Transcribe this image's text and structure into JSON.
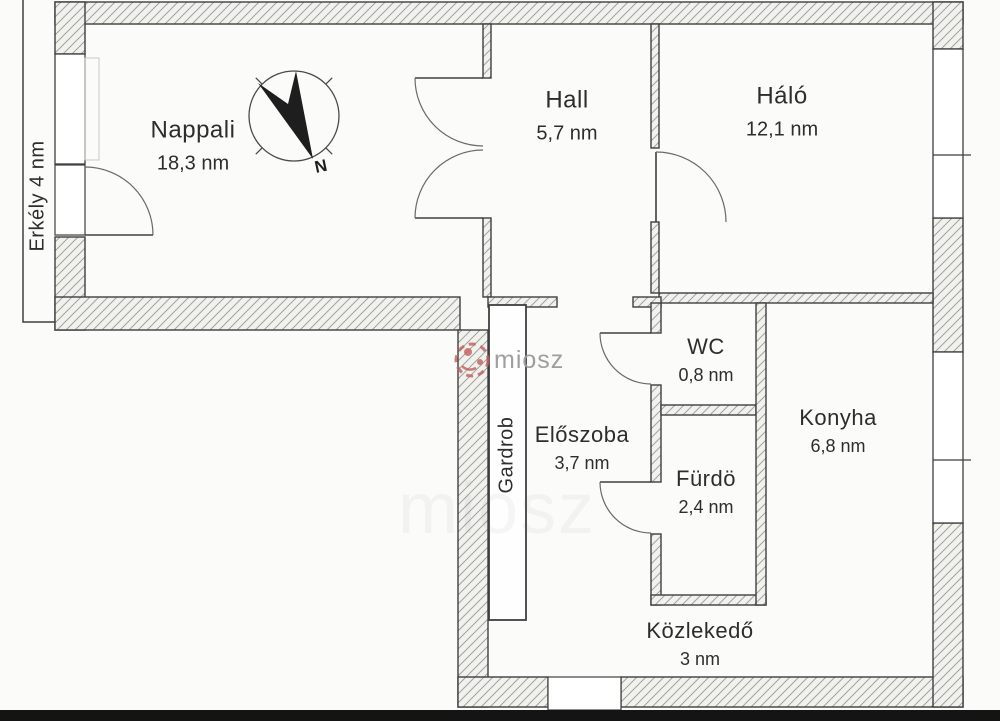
{
  "title": "Apartment floor plan",
  "watermark": {
    "text": "miosz",
    "accent_color": "#c2605c",
    "text_color": "#9a9a9a"
  },
  "compass": {
    "north_label": "N"
  },
  "rooms": [
    {
      "name": "Nappali",
      "area": "18,3 nm"
    },
    {
      "name": "Hall",
      "area": "5,7 nm"
    },
    {
      "name": "Háló",
      "area": "12,1 nm"
    },
    {
      "name": "WC",
      "area": "0,8 nm"
    },
    {
      "name": "Konyha",
      "area": "6,8 nm"
    },
    {
      "name": "Előszoba",
      "area": "3,7 nm"
    },
    {
      "name": "Fürdö",
      "area": "2,4 nm"
    },
    {
      "name": "Közlekedő",
      "area": "3 nm"
    },
    {
      "name": "Gardrob",
      "area": ""
    },
    {
      "name": "Erkély 4 nm",
      "area": ""
    }
  ]
}
